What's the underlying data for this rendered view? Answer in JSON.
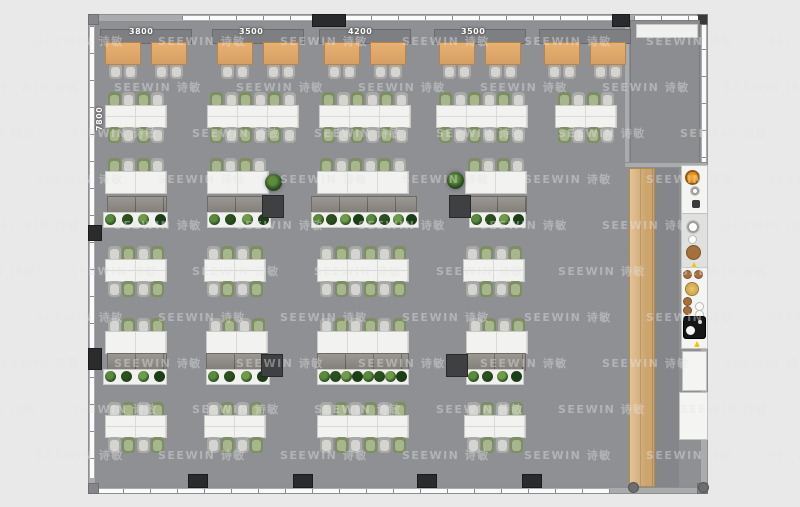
{
  "watermark": {
    "text": "SEEWIN 诗敏",
    "rows": 10,
    "cols": 7,
    "x0": 36,
    "y0": 33,
    "row_h": 46,
    "col_w": 122,
    "stagger": 44
  },
  "labels": {
    "top_dimensions": [
      {
        "text": "3800",
        "x": 129
      },
      {
        "text": "3500",
        "x": 239
      },
      {
        "text": "4200",
        "x": 348
      },
      {
        "text": "3500",
        "x": 461
      }
    ],
    "left_dimension": {
      "text": "7800"
    }
  },
  "colors": {
    "bg": "#e9e9e9",
    "floor": "#8e9094",
    "wall": "#a9abad",
    "wood": "#d9af74",
    "desk": "#f2f3f0",
    "credenza": "#8d8983",
    "banquette": "#7e7f83",
    "column": "#2a2b2d",
    "orange": "#d97f06",
    "chair_green": "#8fa372",
    "chair_gray": "#c2c3bf",
    "plant_green": "#3f6b2a"
  },
  "plan": {
    "cafe": {
      "banquettes": [
        101,
        213,
        320,
        435,
        540
      ],
      "tables": [
        106,
        152,
        218,
        264,
        325,
        371,
        440,
        486,
        545,
        591
      ]
    },
    "desk_rows": [
      {
        "y": 92,
        "sides": "both",
        "start": "green",
        "clusters": [
          {
            "x": 106,
            "m": 2
          },
          {
            "x": 208,
            "m": 3
          },
          {
            "x": 320,
            "m": 3
          },
          {
            "x": 437,
            "m": 3
          },
          {
            "x": 556,
            "m": 2
          }
        ]
      },
      {
        "y": 158,
        "sides": "top",
        "start": "green",
        "clusters": [
          {
            "x": 106,
            "m": 2
          },
          {
            "x": 208,
            "m": 2
          },
          {
            "x": 318,
            "m": 3
          },
          {
            "x": 466,
            "m": 2
          }
        ]
      },
      {
        "y": 246,
        "sides": "both",
        "start": "gray",
        "clusters": [
          {
            "x": 106,
            "m": 2
          },
          {
            "x": 205,
            "m": 2
          },
          {
            "x": 318,
            "m": 3
          },
          {
            "x": 464,
            "m": 2
          }
        ]
      },
      {
        "y": 318,
        "sides": "top",
        "start": "gray",
        "clusters": [
          {
            "x": 106,
            "m": 2
          },
          {
            "x": 207,
            "m": 2
          },
          {
            "x": 318,
            "m": 3
          },
          {
            "x": 467,
            "m": 2
          }
        ]
      },
      {
        "y": 402,
        "sides": "both",
        "start": "gray",
        "clusters": [
          {
            "x": 106,
            "m": 2
          },
          {
            "x": 205,
            "m": 2
          },
          {
            "x": 318,
            "m": 3
          },
          {
            "x": 465,
            "m": 2
          }
        ]
      }
    ],
    "returns": [
      {
        "y": 197,
        "items": [
          {
            "cx": 108,
            "cw": 58,
            "px": 104,
            "pw": 63,
            "plants": 4
          },
          {
            "cx": 208,
            "cw": 56,
            "px": 208,
            "pw": 62,
            "plants": 4
          },
          {
            "cx": 312,
            "cw": 104,
            "px": 312,
            "pw": 106,
            "plants": 8
          },
          {
            "cx": 470,
            "cw": 56,
            "px": 470,
            "pw": 55,
            "plants": 4
          }
        ]
      },
      {
        "y": 354,
        "items": [
          {
            "cx": 108,
            "cw": 58,
            "px": 104,
            "pw": 62,
            "plants": 4
          },
          {
            "cx": 207,
            "cw": 60,
            "px": 207,
            "pw": 62,
            "plants": 4
          },
          {
            "cx": 318,
            "cw": 90,
            "px": 318,
            "pw": 90,
            "plants": 8
          },
          {
            "cx": 467,
            "cw": 58,
            "px": 467,
            "pw": 56,
            "plants": 4
          }
        ]
      }
    ],
    "side_tables": [
      {
        "x": 263,
        "y": 196
      },
      {
        "x": 450,
        "y": 196
      },
      {
        "x": 262,
        "y": 355
      },
      {
        "x": 447,
        "y": 355
      }
    ],
    "plants": [
      {
        "x": 265,
        "y": 174
      },
      {
        "x": 447,
        "y": 172
      }
    ],
    "columns": {
      "top": [
        {
          "x": 312,
          "w": 34
        },
        {
          "x": 612,
          "w": 18
        }
      ],
      "bottom": [
        {
          "x": 188,
          "w": 20
        },
        {
          "x": 293,
          "w": 20
        },
        {
          "x": 417,
          "w": 20
        },
        {
          "x": 522,
          "w": 20
        }
      ],
      "left": [
        {
          "y": 225,
          "h": 16
        },
        {
          "y": 348,
          "h": 22
        }
      ]
    },
    "kitchen": {
      "panels": [
        {
          "x": 682,
          "y": 166,
          "w": 25,
          "h": 48,
          "tone": "white",
          "icons": [
            {
              "n": "burner-icon",
              "t": "circle",
              "x": 687,
              "y": 172,
              "s": 11
            },
            {
              "n": "knob-icon",
              "t": "ring",
              "x": 691,
              "y": 187,
              "s": 8
            },
            {
              "n": "speaker-icon",
              "t": "dark",
              "x": 692,
              "y": 200,
              "s": 8
            }
          ]
        },
        {
          "x": 682,
          "y": 214,
          "w": 25,
          "h": 54,
          "tone": "gray",
          "icons": [
            {
              "n": "toilet-icon",
              "t": "ring",
              "x": 687,
              "y": 221,
              "s": 12
            },
            {
              "n": "cistern-icon",
              "t": "white",
              "x": 689,
              "y": 236,
              "s": 7
            },
            {
              "n": "appliance-icon",
              "t": "brown",
              "x": 687,
              "y": 246,
              "s": 13
            },
            {
              "n": "alert-icon",
              "t": "warn",
              "x": 691,
              "y": 262,
              "s": 6
            }
          ]
        },
        {
          "x": 682,
          "y": 268,
          "w": 25,
          "h": 80,
          "tone": "white",
          "icons": [
            {
              "n": "plant-pot-icon",
              "t": "brown",
              "x": 684,
              "y": 271,
              "s": 7
            },
            {
              "n": "plant-pot-icon",
              "t": "brown",
              "x": 695,
              "y": 271,
              "s": 7
            },
            {
              "n": "sink-icon",
              "t": "gold",
              "x": 686,
              "y": 283,
              "s": 12
            },
            {
              "n": "jar-icon",
              "t": "brown",
              "x": 684,
              "y": 298,
              "s": 7
            },
            {
              "n": "jar-icon",
              "t": "brown",
              "x": 684,
              "y": 307,
              "s": 7
            },
            {
              "n": "dot-icon",
              "t": "white",
              "x": 696,
              "y": 303,
              "s": 7
            },
            {
              "n": "dot-icon",
              "t": "white",
              "x": 696,
              "y": 311,
              "s": 7
            },
            {
              "n": "cooktop-icon",
              "t": "cooktop",
              "x": 684,
              "y": 317,
              "s": 21
            },
            {
              "n": "alert-icon",
              "t": "warn",
              "x": 694,
              "y": 341,
              "s": 6
            }
          ]
        },
        {
          "x": 683,
          "y": 352,
          "w": 23,
          "h": 38,
          "tone": "white",
          "icons": []
        },
        {
          "x": 680,
          "y": 393,
          "w": 27,
          "h": 46,
          "tone": "white",
          "icons": []
        }
      ]
    }
  }
}
